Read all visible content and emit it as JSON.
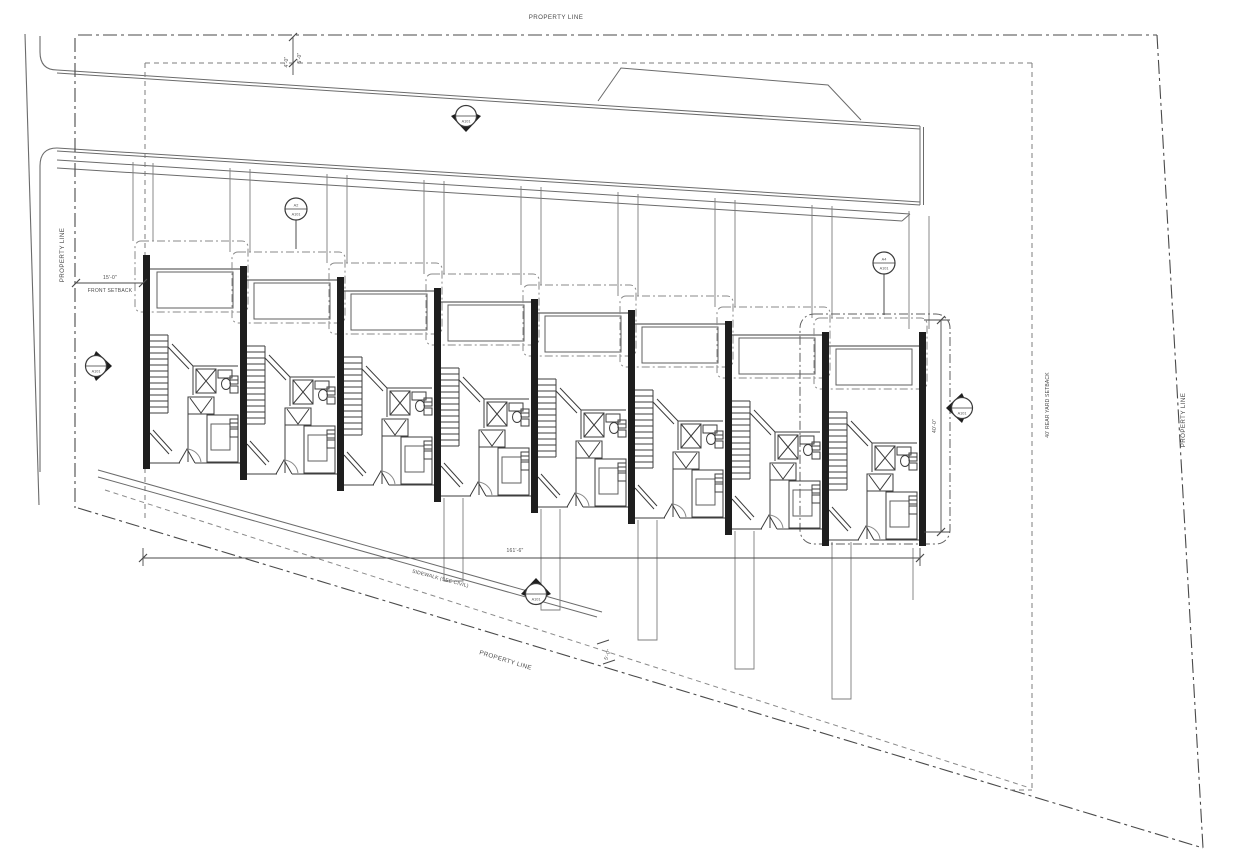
{
  "drawing": {
    "type": "Townhouse Row Site Plan",
    "unit_count": 8,
    "colors": {
      "background": "#ffffff",
      "line_dark": "#3a3a3a",
      "line_mid": "#5f5f5f",
      "line_light": "#8a8a8a",
      "wall_fill": "#1e1e1e"
    }
  },
  "labels": {
    "property_line_top": "PROPERTY LINE",
    "property_line_left": "PROPERTY LINE",
    "property_line_right": "PROPERTY LINE",
    "property_line_bottom": "PROPERTY LINE",
    "front_setback_dim": "15'-0\"",
    "front_setback": "FRONT SETBACK",
    "rear_setback": "40' REAR YARD SETBACK",
    "sidewalk": "SIDEWALK (SEE CIVIL)",
    "overall_width_dim": "161'-6\"",
    "unit_depth_dim": "40'-0\"",
    "walk_offset_dim": "5'-0\"",
    "top_offset_dim_a": "4'-0\"",
    "top_offset_dim_b": "5'-0\""
  },
  "markers": {
    "section_top": {
      "top": "",
      "bottom": "A101"
    },
    "callout_left": {
      "top": "A2",
      "bottom": "A101"
    },
    "callout_right": {
      "top": "A4",
      "bottom": "A101"
    },
    "elev_left": {
      "top": "",
      "bottom": "A101"
    },
    "elev_right": {
      "top": "",
      "bottom": "A101"
    },
    "elev_bottom": {
      "top": "",
      "bottom": "A101"
    }
  }
}
